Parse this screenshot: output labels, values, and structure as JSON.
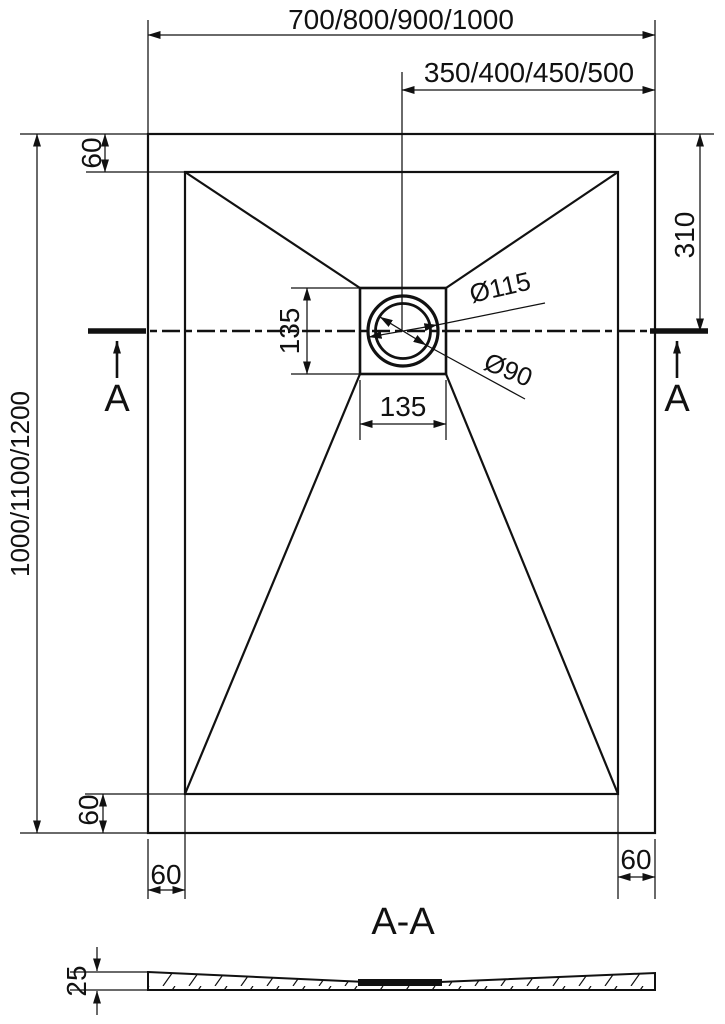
{
  "drawing": {
    "dims": {
      "width_overall": "700/800/900/1000",
      "width_center": "350/400/450/500",
      "height_overall": "1000/1100/1200",
      "inset_top": "60",
      "drain_offset": "310",
      "drain_box_height": "135",
      "drain_box_width": "135",
      "dia_outer": "Ø115",
      "dia_inner": "Ø90",
      "inset_bottom": "60",
      "inset_bottom_left": "60",
      "inset_bottom_right": "60",
      "thickness": "25"
    },
    "labels": {
      "section_left": "A",
      "section_right": "A",
      "section_title": "A-A"
    },
    "colors": {
      "ink": "#111111",
      "background": "#ffffff"
    }
  }
}
